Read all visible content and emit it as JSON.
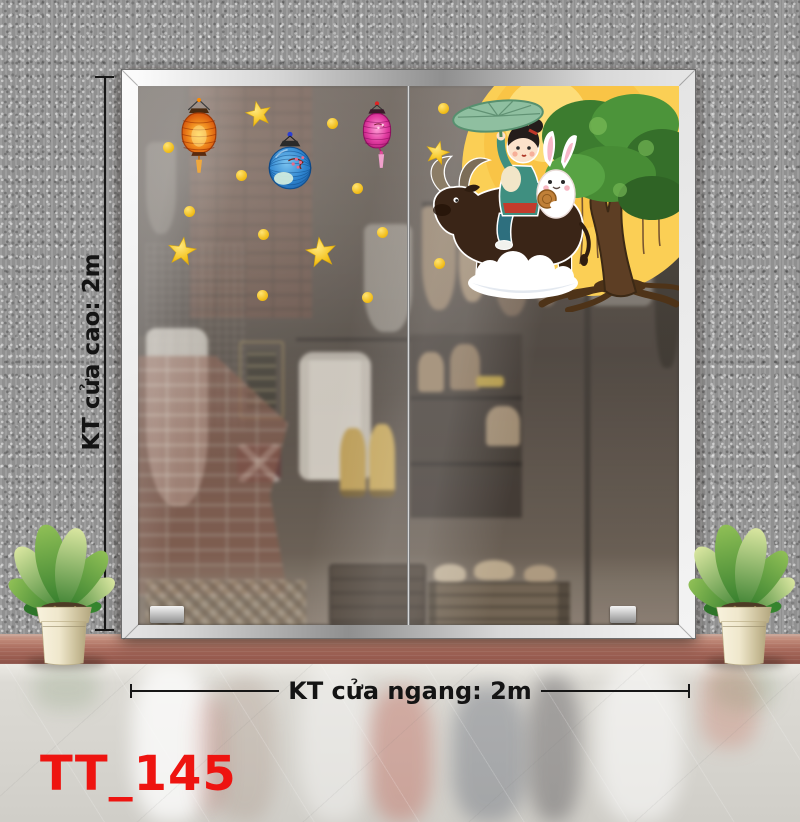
{
  "product": {
    "code": "TT_145"
  },
  "annotations": {
    "height_label": "KT cửa cao: 2m",
    "width_label": "KT cửa ngang: 2m"
  },
  "door": {
    "panel_count": 2,
    "decals": {
      "lanterns": [
        "orange paper lantern",
        "blue round lantern",
        "pink paper lantern"
      ],
      "stars_count": 4,
      "gold_dots_count": 11,
      "main_scene": "girl with rabbit riding a water buffalo under a lotus-leaf umbrella, full moon, banyan tree and cloud (Mid-Autumn decal)"
    }
  },
  "scene": {
    "left_plant": "potted plant in cream pot",
    "right_plant": "potted plant in cream pot",
    "background": "grey speckled wall, terracotta skirting, glossy showroom floor with reflections"
  },
  "colors": {
    "code_text": "#ee1410",
    "dimension_text": "#141414",
    "wall": "#989898",
    "frame_silver": "#d6d6d6",
    "skirting": "#a96b5d",
    "floor": "#d6d4ce",
    "moon": "#fbcf55",
    "star": "#f1bd1a",
    "lantern_orange": "#e85c15",
    "lantern_blue": "#2e85d0",
    "lantern_pink": "#e0399f",
    "tree_green": "#4c943a",
    "cloud": "#ffffff",
    "pot_cream": "#efe7cc"
  }
}
